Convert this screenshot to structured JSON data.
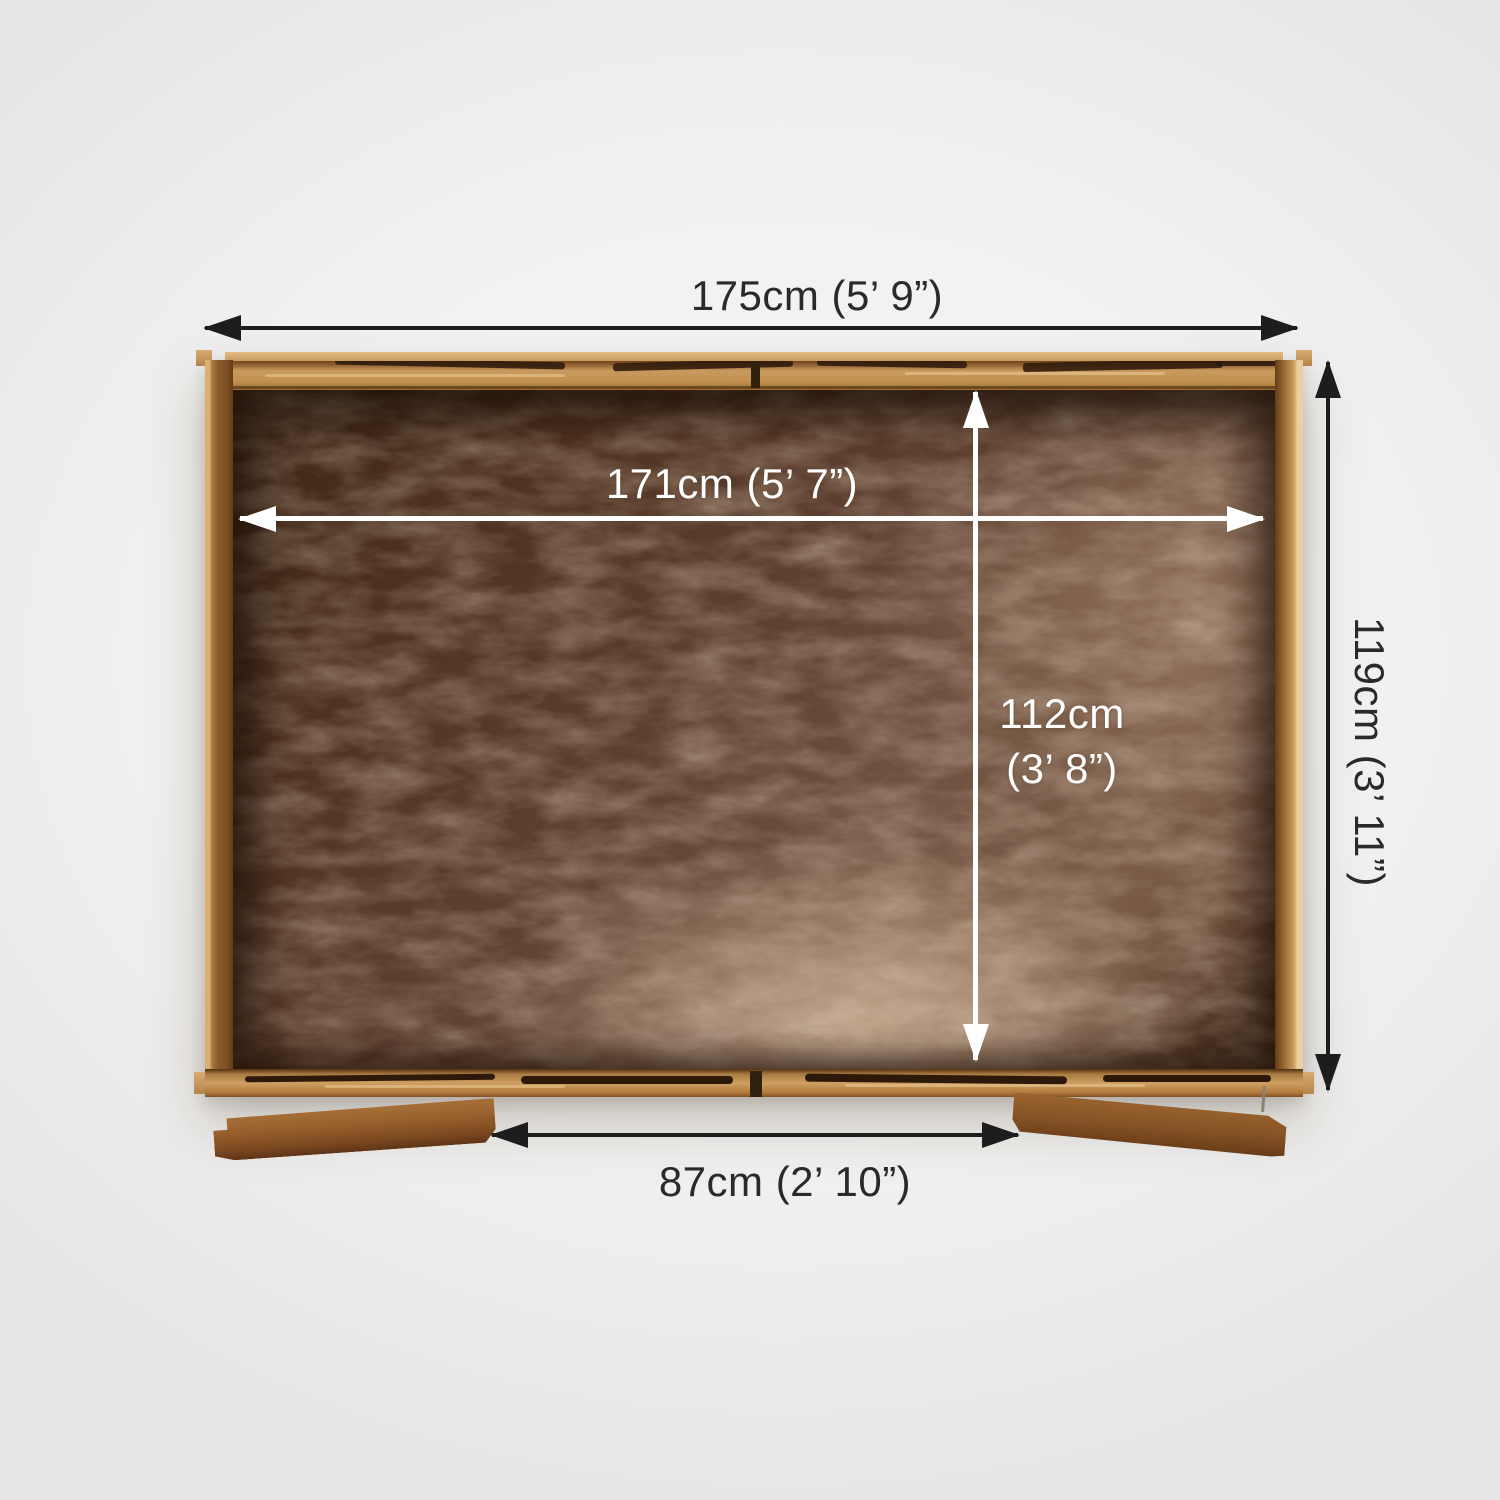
{
  "dimensions": {
    "external_width": {
      "label": "175cm (5’ 9”)",
      "orientation": "horizontal",
      "style": "dark"
    },
    "internal_width": {
      "label": "171cm (5’ 7”)",
      "orientation": "horizontal",
      "style": "light"
    },
    "external_depth": {
      "label": "119cm (3’ 11”)",
      "orientation": "vertical",
      "style": "dark"
    },
    "internal_depth": {
      "value": "112cm",
      "imperial": "(3’ 8”)",
      "orientation": "vertical",
      "style": "light"
    },
    "door_width": {
      "label": "87cm (2’ 10”)",
      "orientation": "horizontal",
      "style": "dark"
    }
  },
  "colors": {
    "bg": "#f1f1f0",
    "dim_dark": "#1d1d1d",
    "dim_light": "#ffffff",
    "label_dark": "#2a2a2a",
    "wood_frame_light": "#cf9f63",
    "wood_frame_mid": "#b07a3c",
    "wood_wall_dark": "#7c4e22",
    "floor_dark": "#4c3020",
    "floor_light": "#ab8d77"
  }
}
